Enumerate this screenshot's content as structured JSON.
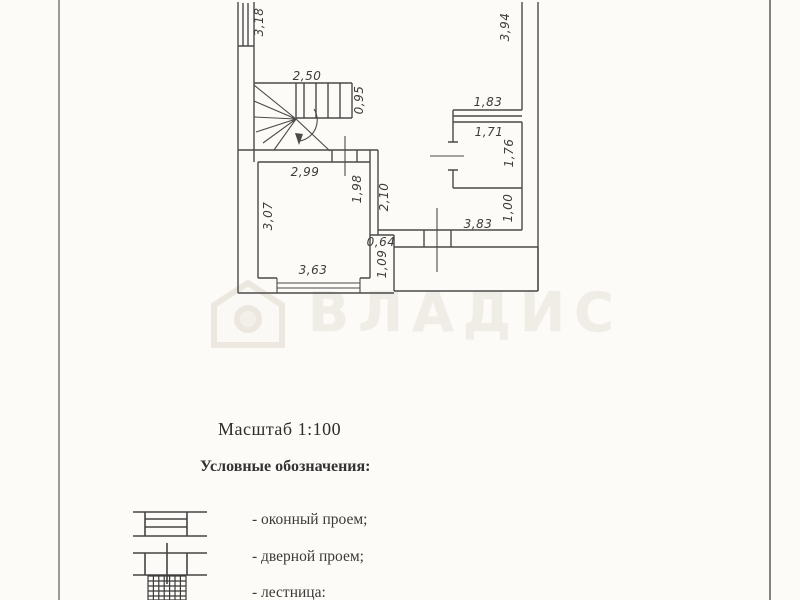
{
  "watermark": {
    "text": "ВЛАДИС",
    "color": "#f0ede6"
  },
  "plan": {
    "line_color": "#4a4a4a",
    "dimensions": [
      {
        "text": "3,18",
        "orientation": "vertical"
      },
      {
        "text": "2,50",
        "orientation": "horizontal"
      },
      {
        "text": "0,95",
        "orientation": "vertical"
      },
      {
        "text": "3,94",
        "orientation": "vertical"
      },
      {
        "text": "1,83",
        "orientation": "horizontal"
      },
      {
        "text": "1,71",
        "orientation": "horizontal"
      },
      {
        "text": "1,76",
        "orientation": "vertical"
      },
      {
        "text": "1,00",
        "orientation": "vertical"
      },
      {
        "text": "3,83",
        "orientation": "horizontal"
      },
      {
        "text": "2,99",
        "orientation": "horizontal"
      },
      {
        "text": "1,98",
        "orientation": "vertical"
      },
      {
        "text": "2,10",
        "orientation": "vertical"
      },
      {
        "text": "3,07",
        "orientation": "vertical"
      },
      {
        "text": "0,64",
        "orientation": "horizontal"
      },
      {
        "text": "1,09",
        "orientation": "vertical"
      },
      {
        "text": "3,63",
        "orientation": "horizontal"
      }
    ]
  },
  "scale": {
    "label": "Масштаб 1:100"
  },
  "legend": {
    "title": "Условные обозначения:",
    "items": [
      {
        "symbol": "window-opening",
        "label": "- оконный проем;"
      },
      {
        "symbol": "door-opening",
        "label": "- дверной проем;"
      },
      {
        "symbol": "stairs",
        "label": "- лестница:"
      }
    ]
  }
}
